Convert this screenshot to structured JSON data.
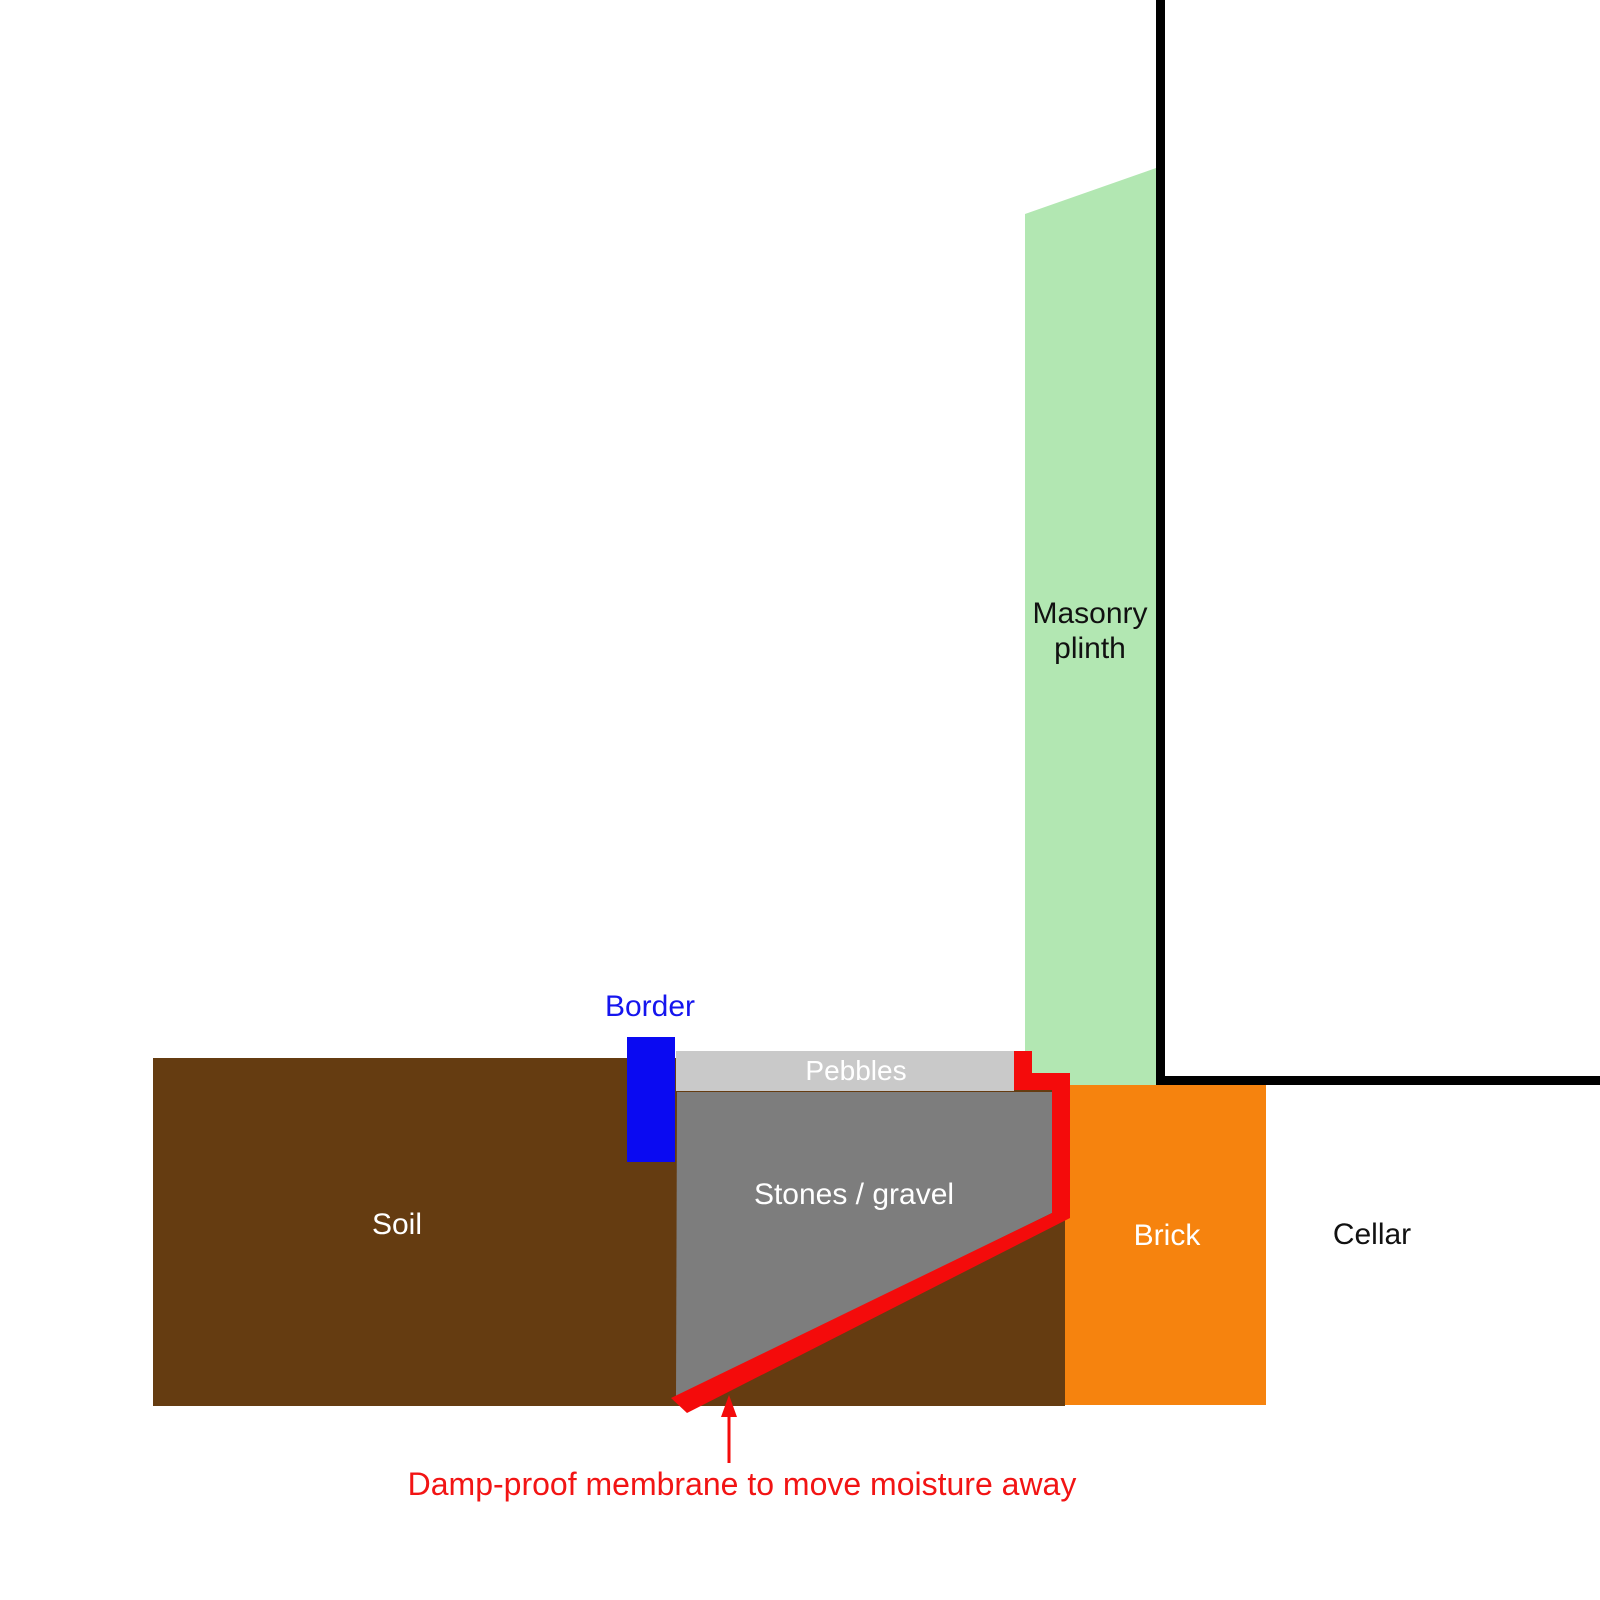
{
  "diagram": {
    "labels": {
      "soil": "Soil",
      "pebbles": "Pebbles",
      "stones": "Stones / gravel",
      "border": "Border",
      "masonry_plinth": "Masonry plinth",
      "brick": "Brick",
      "cellar": "Cellar",
      "membrane_note": "Damp-proof membrane to move moisture away"
    },
    "colors": {
      "soil": "#653c11",
      "stones_gravel": "#7d7d7d",
      "pebbles": "#c9c9c9",
      "masonry_plinth": "#b2e7b2",
      "brick": "#f6830e",
      "membrane": "#f40b0b",
      "border": "#0a0af2",
      "border_label": "#1515ee",
      "note_text": "#f21414",
      "wall_outline": "#000000",
      "light_text": "#ffffff",
      "dark_text": "#111111"
    }
  }
}
